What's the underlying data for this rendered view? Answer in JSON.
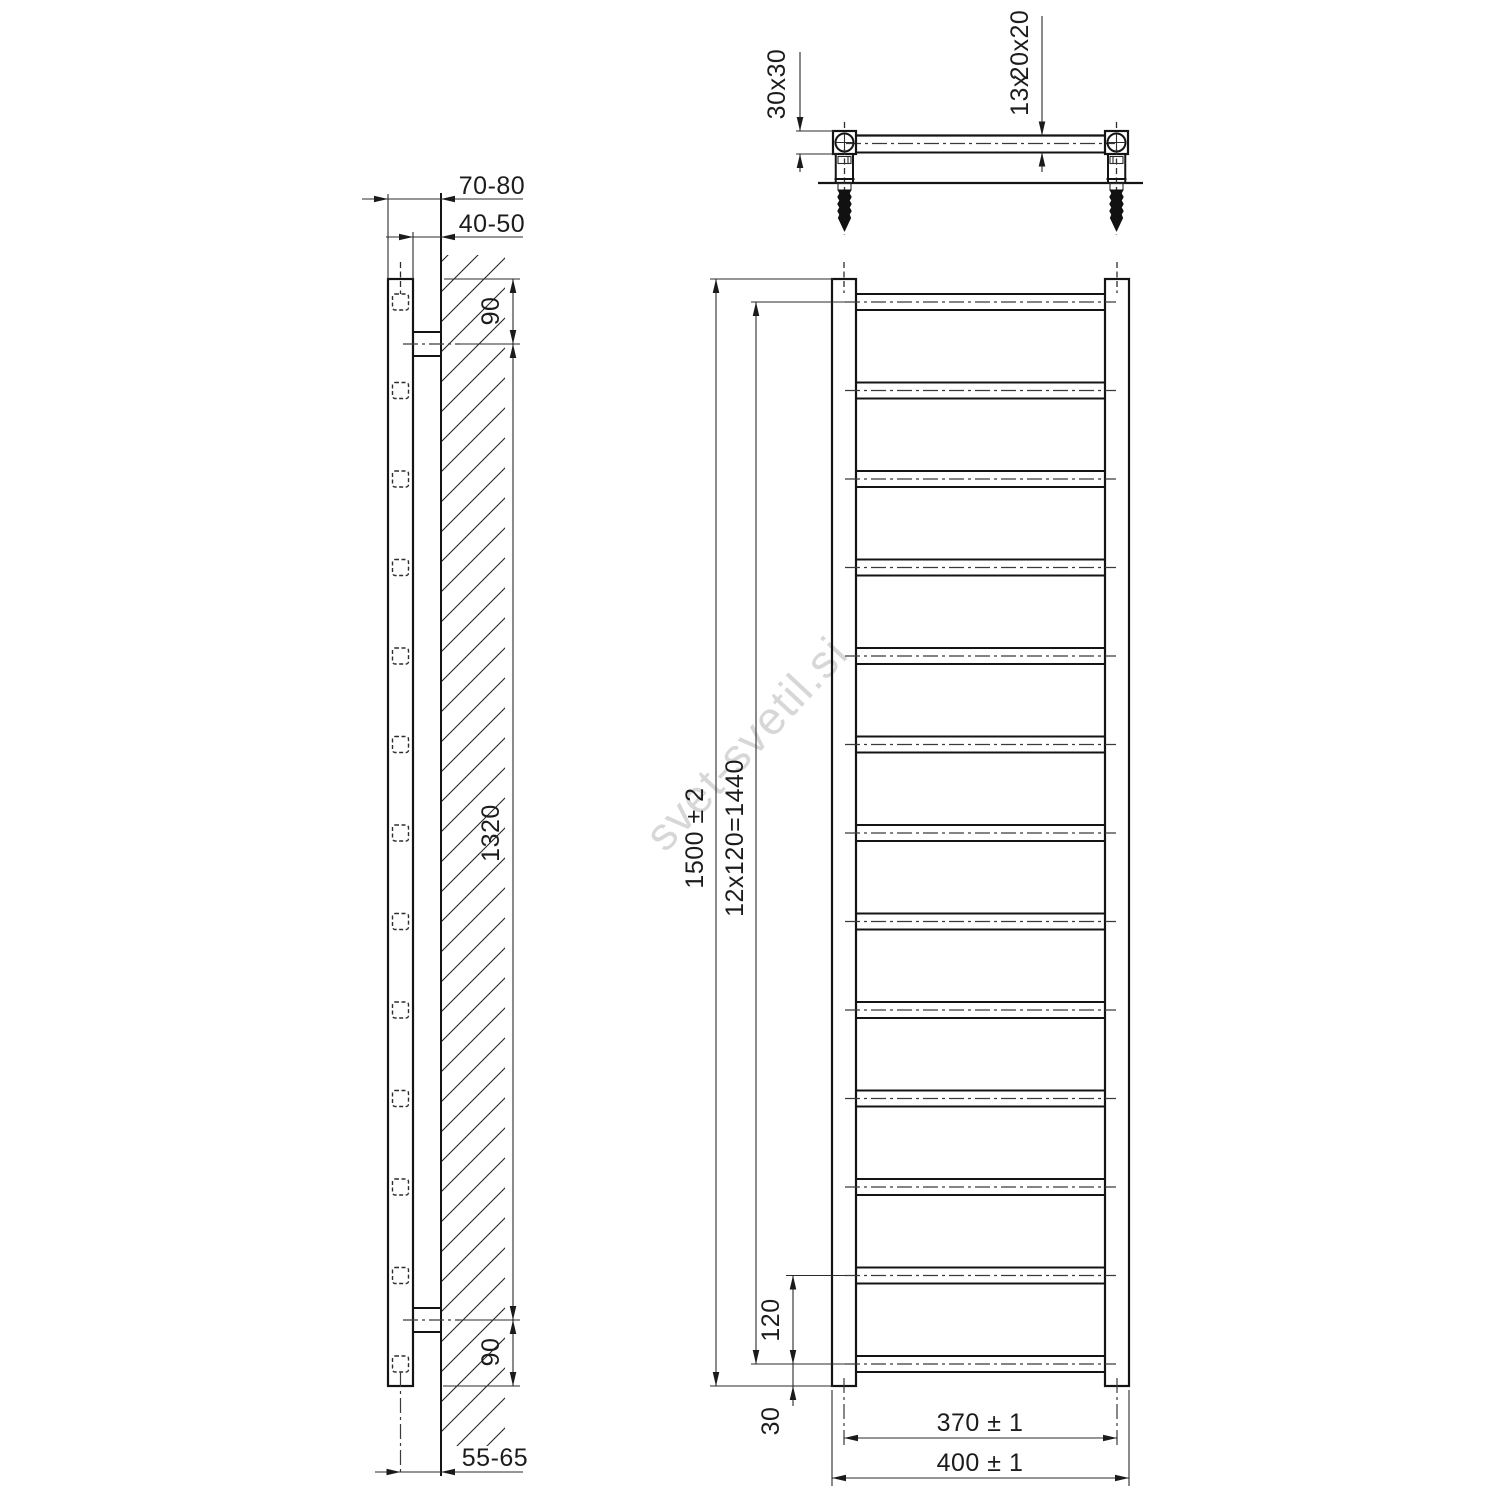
{
  "watermark": {
    "text": "svet-svetil.si",
    "color": "#d7d7d7"
  },
  "drawing": {
    "rung_count": 13,
    "first_rung_y": 302,
    "rung_pitch_px": 88.5
  },
  "top_view": {
    "tube_section_label": "30x30",
    "rung_count_label": "13x",
    "rung_section_label": "20x20"
  },
  "side_view": {
    "wall_offset_front_label": "70-80",
    "wall_offset_back_label": "40-50",
    "top_bracket_offset_label": "90",
    "bracket_span_label": "1320",
    "bottom_bracket_offset_label": "90",
    "axis_to_wall_label": "55-65"
  },
  "front_view": {
    "overall_height_label": "1500 ± 2",
    "rung_pitch_label": "12x120=1440",
    "bottom_pitch_label": "120",
    "bottom_offset_label": "30",
    "axis_width_label": "370 ± 1",
    "overall_width_label": "400 ± 1"
  }
}
